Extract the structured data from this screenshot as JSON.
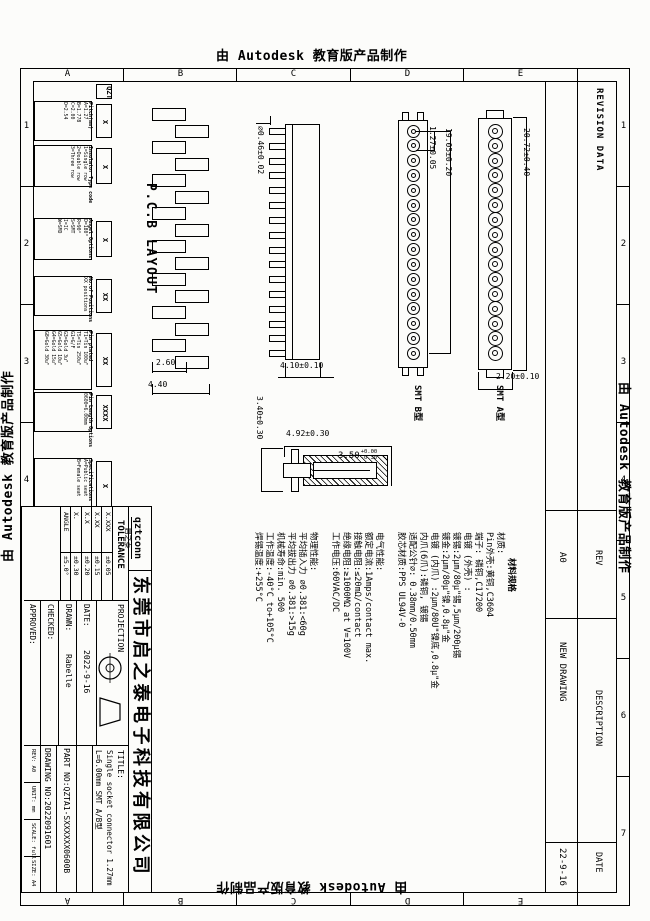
{
  "banners": {
    "autodesk": "由 Autodesk 教育版产品制作"
  },
  "zones": {
    "letters": [
      "A",
      "B",
      "C",
      "D",
      "E"
    ],
    "numbers": [
      "1",
      "2",
      "3",
      "4",
      "5",
      "6",
      "7"
    ]
  },
  "pcb_layout": {
    "label": "P.C.B LAYOUT"
  },
  "order_code": {
    "prefix": "QZT",
    "fields": [
      {
        "code": "X",
        "title": "Pitch(mm)",
        "lines": [
          "A=1.27",
          "B=1.778",
          "C=2.00",
          "D=2.54"
        ]
      },
      {
        "code": "X",
        "title": "Insulator Type code",
        "lines": [
          "1=Single row",
          "2=Double row",
          "3=Three row"
        ]
      },
      {
        "code": "X",
        "title": "Angel Options",
        "lines": [
          "D=180°",
          "R=90°",
          "S=SMT",
          "I=IC",
          "W=SMD"
        ]
      },
      {
        "code": "XX",
        "title": "No.of Positions",
        "lines": [
          "XX positions"
        ]
      },
      {
        "code": "XX",
        "title": "Pin plated",
        "lines": [
          "T1=Tin 100u\"",
          "T5=Tin 250u\"",
          "G1=G/F",
          "G3=Gold 3u\"",
          "G5=Gold 10u\"",
          "G4=Gold 15u\"",
          "G8=Gold 30u\""
        ]
      },
      {
        "code": "XXXX",
        "title": "Pin Length Options",
        "lines": [
          "0600=6.00mm"
        ]
      },
      {
        "code": "X",
        "title": "Specifications",
        "lines": [
          "A=Public seat",
          "B=Female seat"
        ]
      }
    ]
  },
  "views": {
    "smt_b_label": "SMT B型",
    "smt_a_label": "SMT A型",
    "dims": {
      "pin_dia": "∅0.46±0.02",
      "side_height": "4.10±0.10",
      "pitch": "1.27±0.05",
      "span": "19.05±0.20",
      "overall": "20.72±0.40",
      "body_width": "2.20±0.10",
      "pad_w": "2.60",
      "pad_span": "4.40",
      "sec_height": "3.40±0.30",
      "sec_width": "4.92±0.30",
      "sec_depth": "3.50",
      "sec_depth_tol_up": "+0.00",
      "sec_depth_tol_dn": "-0.30"
    }
  },
  "notes": {
    "header": "材料规格",
    "lines": [
      "材质:",
      "Pin外壳:黄铜,C3604",
      "端子: 磷铜,C17200",
      "电镀 (外壳) :",
      "镀锡:2μm/80μ\"锡,5μm/200μ锡",
      "镀金:2μm/80μ\"镍,0.8μ\"金",
      "电镀 (内爪) :2μm/80U\"镍底,0.8μ\"金",
      "内爪(6爪):磷铜, 镀锡",
      "适配公针∅: 0.38mm/0.50mm",
      "胶芯材质:PPS UL94V-0",
      "",
      "电气性能:",
      "额定电流:1Amps/contact max.",
      "接触电阻:≤20mΩ/contact",
      "绝缘电阻:≥1000MΩ at V=100V",
      "工作电压:60VAC/DC",
      "",
      "物理性能:",
      "平均插入力 ∅0.381:<60g",
      "平均拔出力 ∅0.381:>15g",
      "机械寿命:min. 500",
      "工作温度:-40°C to+105°C",
      "焊锡温度:+255°C"
    ]
  },
  "revision": {
    "title": "REVISION DATA",
    "headers": {
      "rev": "REV",
      "description": "DESCRIPTION",
      "date": "DATE"
    },
    "entry": {
      "rev": "A0",
      "description": "NEW DRAWING",
      "date": "22-9-16"
    }
  },
  "title_block": {
    "logo_top": "qztconn",
    "logo_sub": "启之泰",
    "company": "东莞市启之泰电子科技有限公司",
    "tolerance_label": "TOLERANCE",
    "tolerance_rows": [
      {
        "label": "X.XXX",
        "value": "±0.05"
      },
      {
        "label": "X.XX",
        "value": "±0.15"
      },
      {
        "label": "X.X",
        "value": "±0.20"
      },
      {
        "label": "X.",
        "value": "±0.30"
      },
      {
        "label": "ANGLE",
        "value": "±5.0°"
      }
    ],
    "projection_label": "PROJECTION",
    "date_label": "DATE:",
    "date_value": "2022-9-16",
    "drawn_label": "DRAWN:",
    "drawn_value": "Rabelle",
    "checked_label": "CHECKED:",
    "approved_label": "APPROVED:",
    "title_label": "TITLE:",
    "title_line1": "Single socket connector 1.27mm",
    "title_line2": "L=6.00mm  SMT A/B型",
    "part_no": "PART NO:QZTA1-SXXXXXX0600B",
    "drawing_no": "DRAWING NO:2022091601",
    "minis": [
      {
        "label": "REV:",
        "value": "A0"
      },
      {
        "label": "UNIT:",
        "value": "mm"
      },
      {
        "label": "SCALE:",
        "value": "full"
      },
      {
        "label": "SIZE:",
        "value": "A4"
      }
    ]
  }
}
